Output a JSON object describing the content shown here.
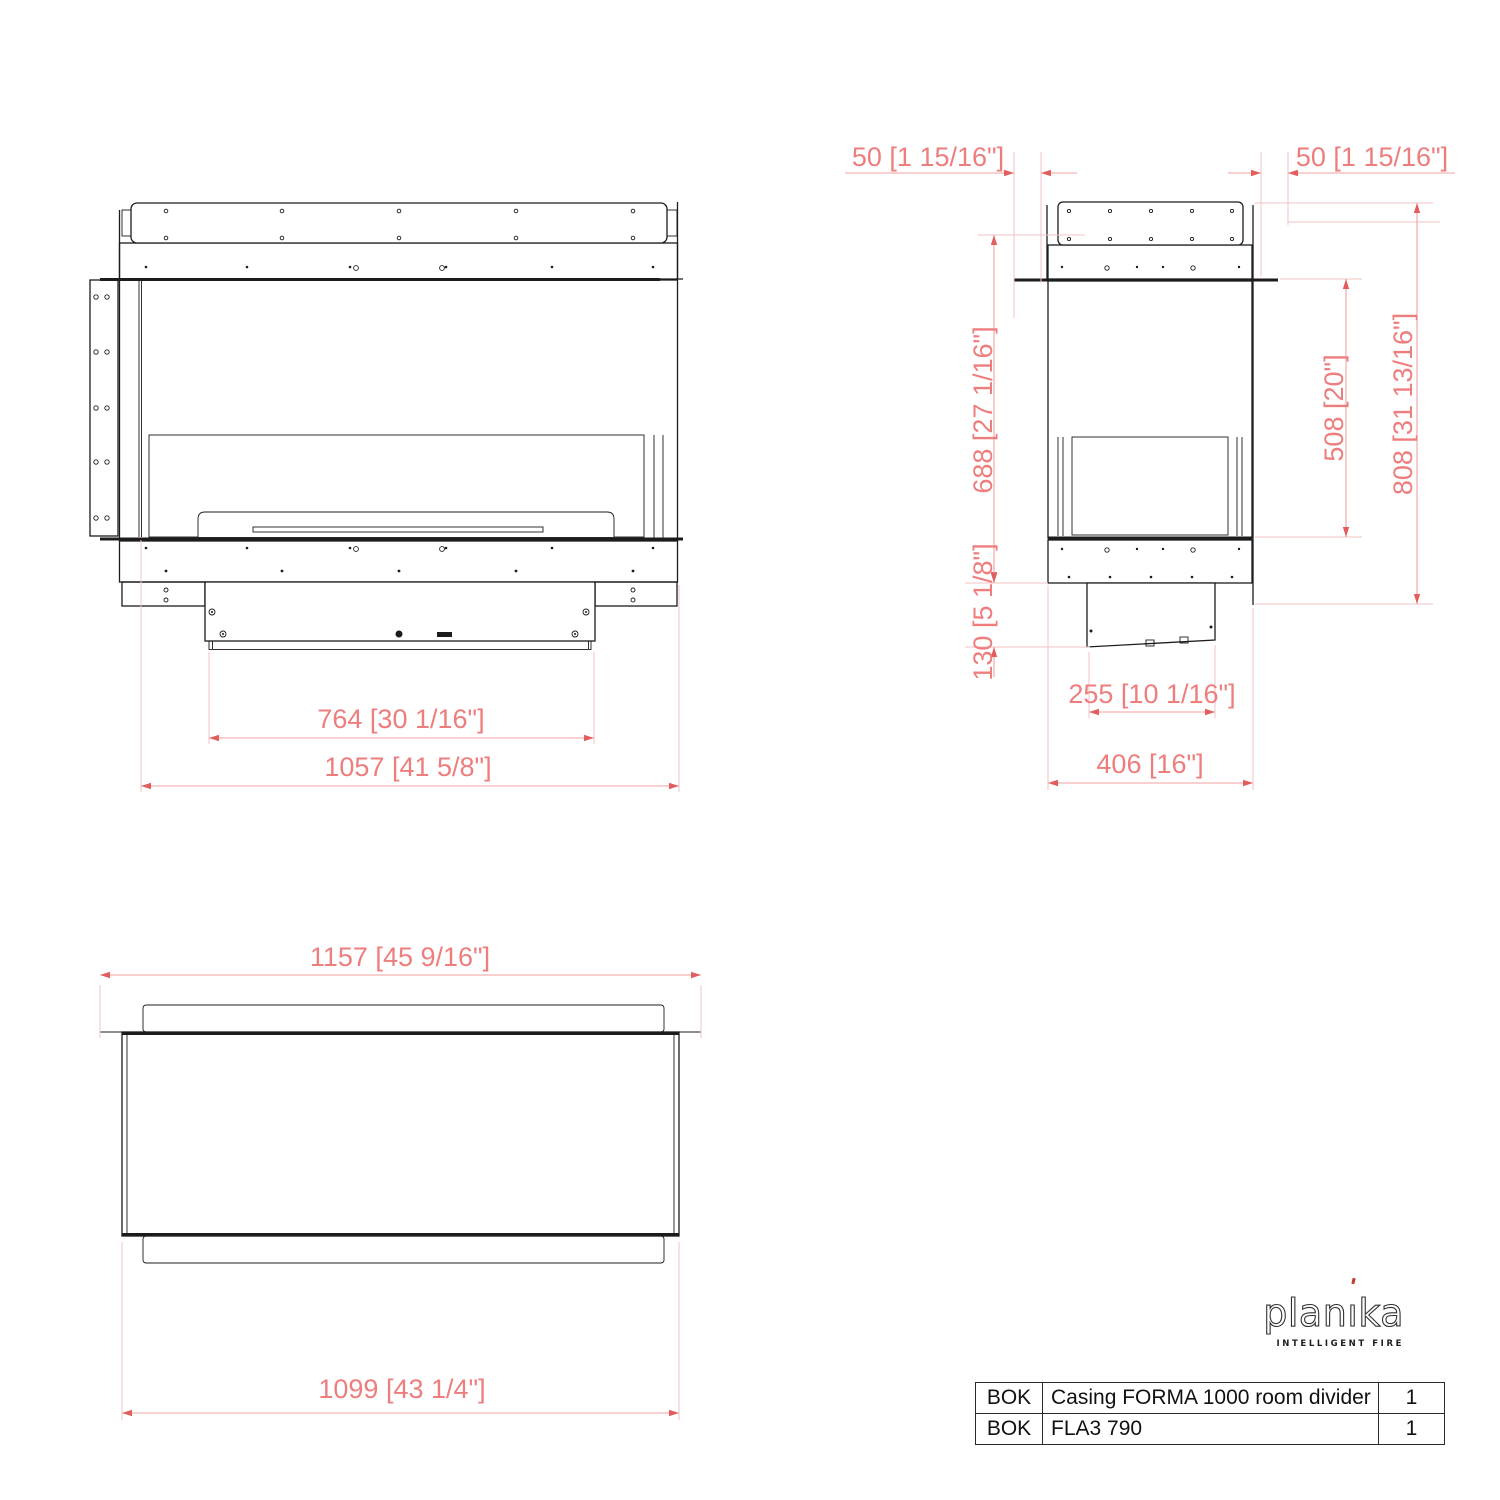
{
  "views": {
    "front": {
      "dims": {
        "inner_width": "764 [30 1/16\"]",
        "outer_width": "1057 [41 5/8\"]"
      }
    },
    "side": {
      "dims": {
        "offset_left": "50 [1 15/16\"]",
        "offset_right": "50 [1 15/16\"]",
        "height_mid": "688 [27 1/16\"]",
        "opening_height": "508 [20\"]",
        "total_height": "808 [31 13/16\"]",
        "box_height": "130 [5 1/8\"]",
        "box_depth": "255 [10 1/16\"]",
        "total_depth": "406 [16\"]"
      }
    },
    "top": {
      "dims": {
        "glass_width": "1157 [45 9/16\"]",
        "casing_width": "1099 [43 1/4\"]"
      }
    }
  },
  "logo": {
    "brand": "planika",
    "tagline": "INTELLIGENT FIRE"
  },
  "parts_table": {
    "rows": [
      {
        "code": "BOK",
        "description": "Casing FORMA 1000 room divider",
        "qty": "1"
      },
      {
        "code": "BOK",
        "description": "FLA3 790",
        "qty": "1"
      }
    ]
  },
  "colors": {
    "drawing_line": "#1c1c1c",
    "dim_text": "#ee7d7d",
    "dim_line": "#f0a2a2",
    "ext_line": "#f4c3c3",
    "arrow": "#e25e5e",
    "logo_accent": "#bf3b30"
  }
}
